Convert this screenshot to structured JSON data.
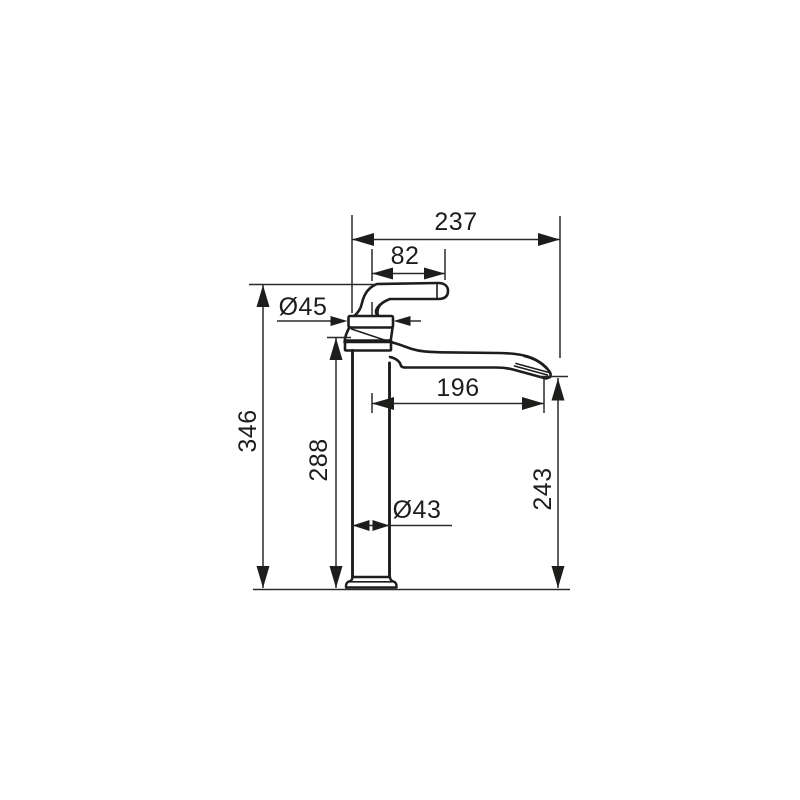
{
  "canvas": {
    "background": "#ffffff",
    "line_color": "#1d1d1b",
    "dimension_color": "#2a2a2a"
  },
  "drawing": {
    "type": "technical dimension drawing",
    "subject": "single-lever high-riser basin mixer faucet, side view",
    "dimensions": {
      "overall_width": "237",
      "handle_length": "82",
      "body_diameter": "Ø45",
      "overall_height": "346",
      "height_to_spout_top": "288",
      "spout_reach": "196",
      "column_diameter": "Ø43",
      "spout_outlet_height": "243"
    }
  }
}
